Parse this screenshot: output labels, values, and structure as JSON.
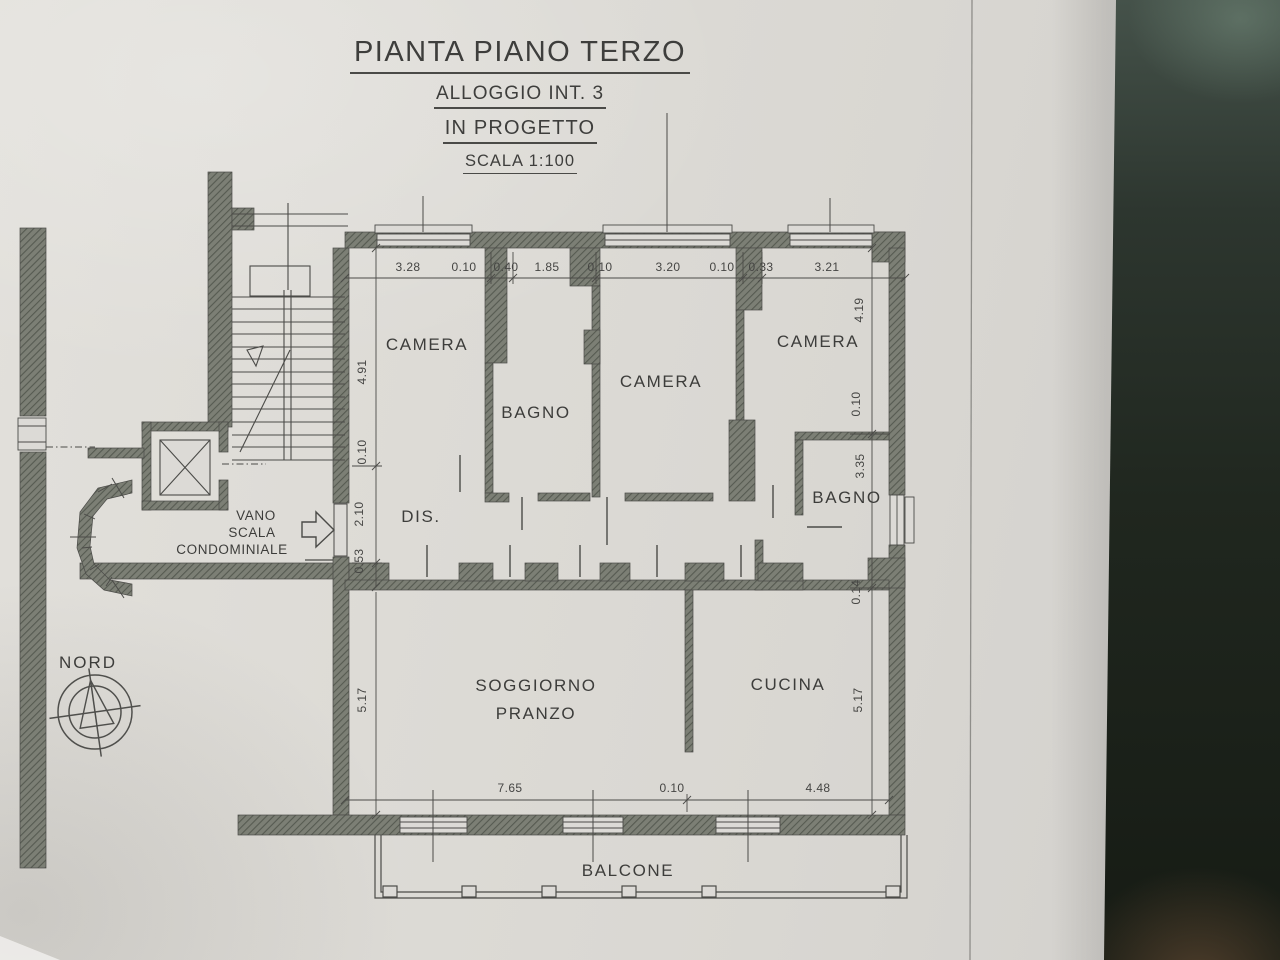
{
  "title_block": {
    "title": "PIANTA PIANO TERZO",
    "subtitle1": "ALLOGGIO INT. 3",
    "subtitle2": "IN PROGETTO",
    "scale": "SCALA 1:100"
  },
  "rooms": {
    "camera_left": "CAMERA",
    "bagno_left": "BAGNO",
    "camera_center": "CAMERA",
    "camera_right": "CAMERA",
    "bagno_right": "BAGNO",
    "disimpegno": "DIS.",
    "soggiorno_line1": "SOGGIORNO",
    "soggiorno_line2": "PRANZO",
    "cucina": "CUCINA",
    "balcone": "BALCONE",
    "stairwell_line1": "VANO",
    "stairwell_line2": "SCALA",
    "stairwell_line3": "CONDOMINIALE"
  },
  "compass": {
    "label": "NORD"
  },
  "dimensions": {
    "top": [
      "3.28",
      "0.10",
      "0.40",
      "1.85",
      "0.10",
      "3.20",
      "0.10",
      "0.33",
      "3.21"
    ],
    "left": [
      "4.91",
      "0.10",
      "2.10",
      "0.53",
      "5.17"
    ],
    "right": [
      "4.19",
      "0.10",
      "3.35",
      "0.14",
      "5.17"
    ],
    "bottom": [
      "7.65",
      "0.10",
      "4.48"
    ]
  },
  "colors": {
    "wall_fill": "#7c7f75",
    "wall_hatch": "#565a51",
    "line": "#4b4b48",
    "paper": "#dcdad6",
    "photo_background": "#1d241f"
  }
}
